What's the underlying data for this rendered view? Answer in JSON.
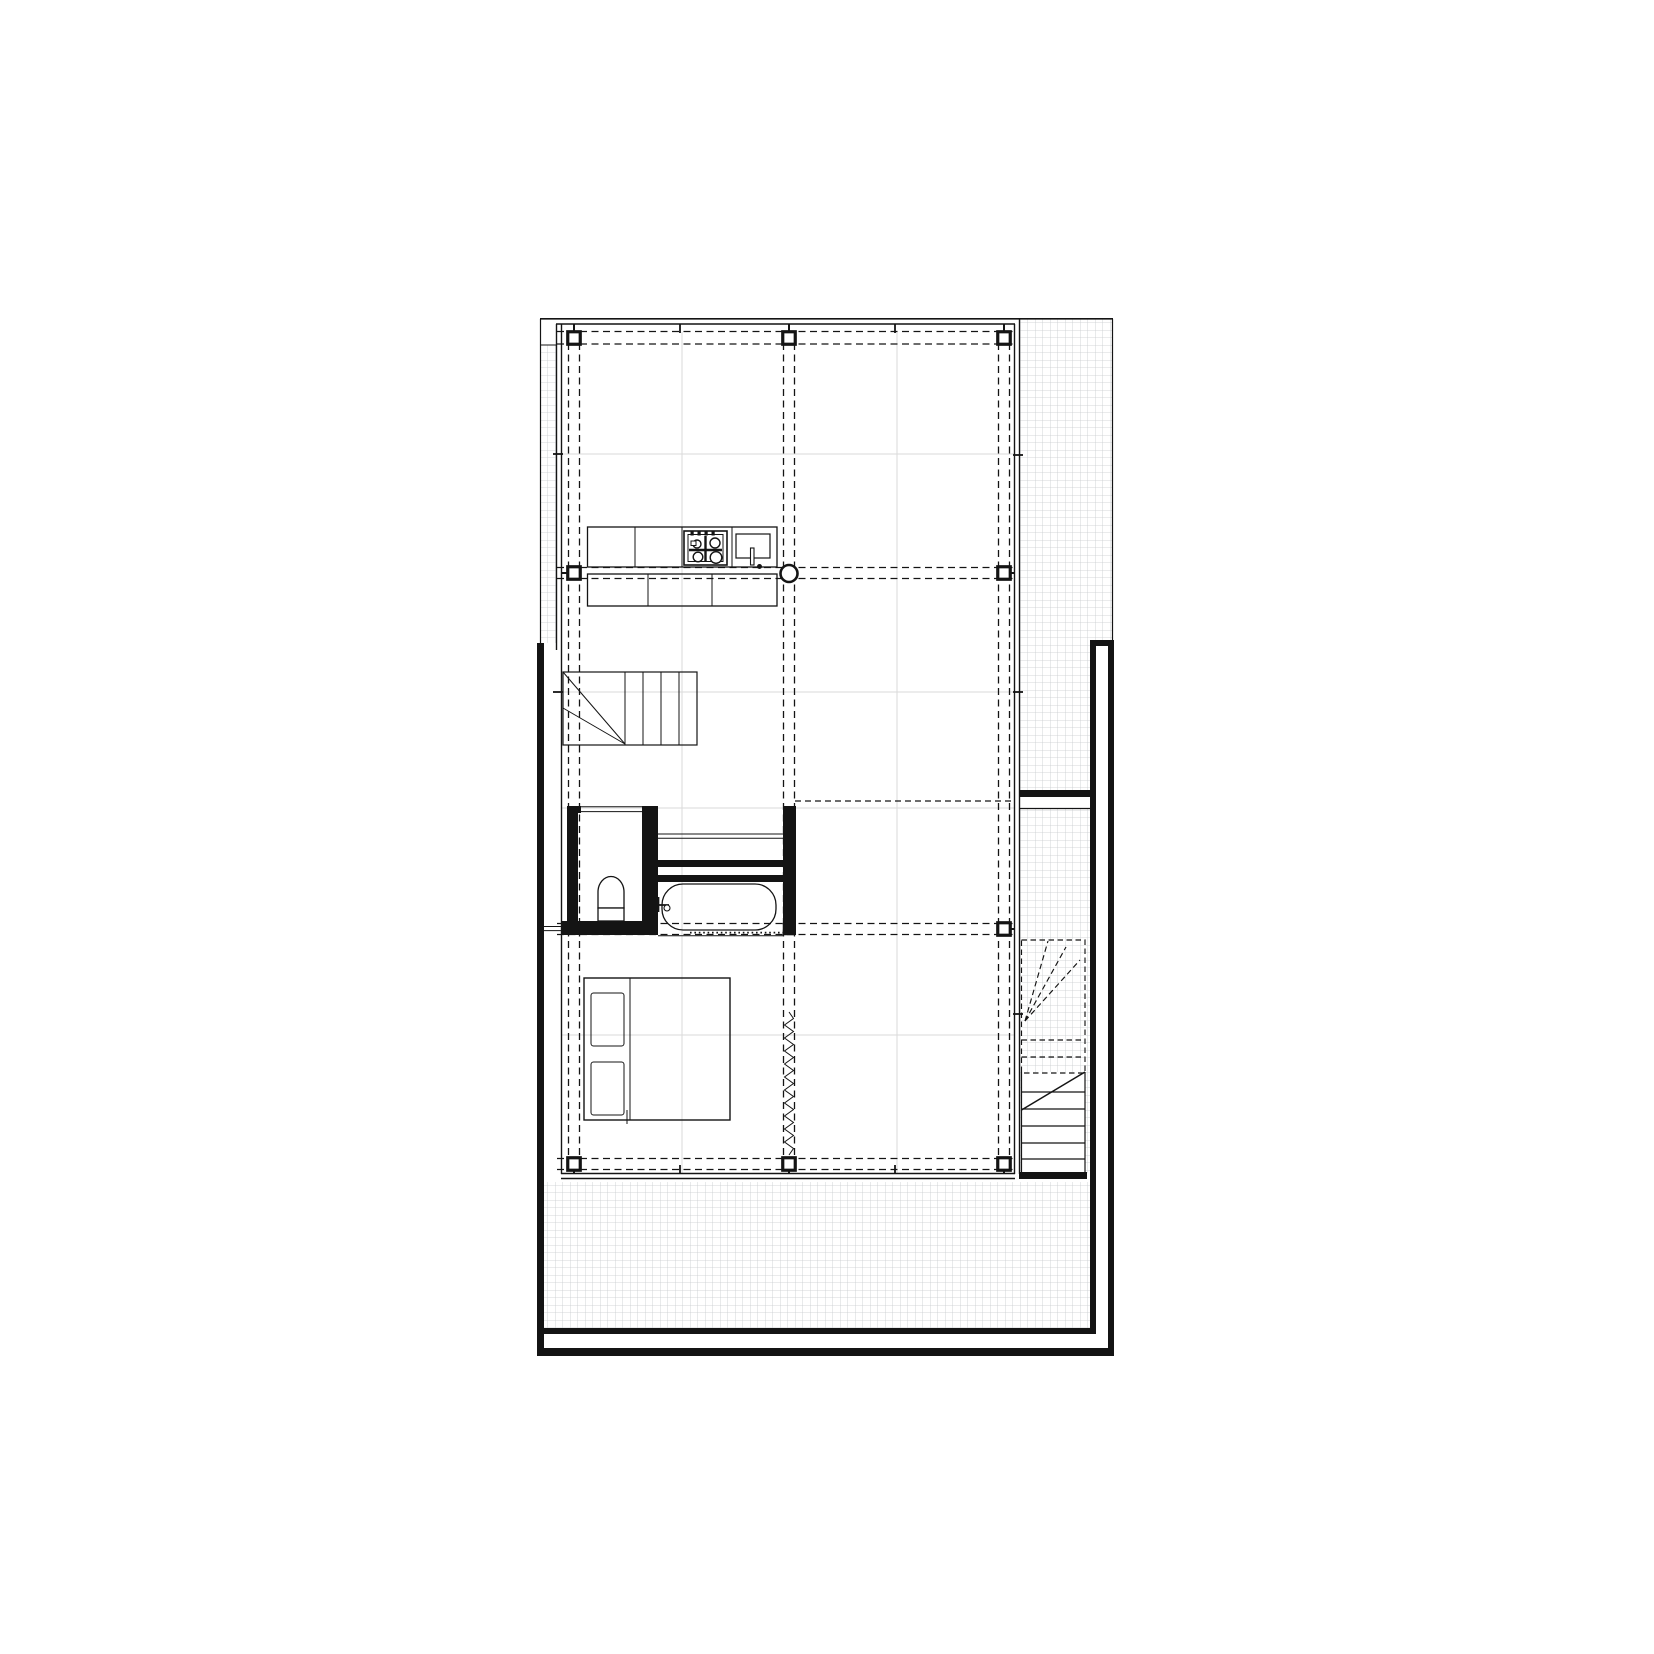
{
  "canvas": {
    "width_px": 1654,
    "height_px": 1654,
    "background": "#ffffff"
  },
  "colors": {
    "ink": "#141414",
    "hatch_line": "#c7cacd",
    "module_line": "#dadada",
    "paper": "#ffffff"
  },
  "hatch": {
    "cell_px": 7.5,
    "pattern": "small-square-grid"
  },
  "structural_grid": {
    "style": "paired dashed axis lines with hollow square columns at intersections",
    "pair_gap_px": 11,
    "vertical_axis_lines_x": [
      568.5,
      579.5,
      783.5,
      794.5,
      998.5,
      1009.5
    ],
    "vertical_extent_y": [
      331.5,
      1170
    ],
    "horizontal_axis_lines_y": [
      331.5,
      344,
      567.5,
      578.5,
      923.5,
      934.5,
      1158.5,
      1169.5
    ],
    "horizontal_extent_x": [
      557,
      1014
    ]
  },
  "columns": {
    "square_size_px": 12.5,
    "items": [
      {
        "cx": 574,
        "cy": 338,
        "style": "open"
      },
      {
        "cx": 789,
        "cy": 338,
        "style": "open"
      },
      {
        "cx": 1004,
        "cy": 338,
        "style": "open"
      },
      {
        "cx": 574,
        "cy": 573,
        "style": "open"
      },
      {
        "cx": 1004,
        "cy": 573,
        "style": "open"
      },
      {
        "cx": 789,
        "cy": 929,
        "style": "filled"
      },
      {
        "cx": 1004,
        "cy": 929,
        "style": "open"
      },
      {
        "cx": 574,
        "cy": 1164,
        "style": "open"
      },
      {
        "cx": 789,
        "cy": 1164,
        "style": "open"
      },
      {
        "cx": 1004,
        "cy": 1164,
        "style": "open"
      }
    ],
    "round_column": {
      "cx": 789,
      "cy": 573.5,
      "r": 8.5
    }
  },
  "curtain": {
    "x": 789,
    "y1": 1012,
    "y2": 1155,
    "amplitude": 4.5,
    "step": 6.5
  },
  "areas": [
    {
      "name": "terrace-strip-left",
      "rect": [
        541,
        345,
        16,
        298
      ]
    },
    {
      "name": "terrace-top-right",
      "rect": [
        1020,
        319,
        93,
        324
      ]
    },
    {
      "name": "terrace-strip-right-upper",
      "rect": [
        1020,
        643,
        70,
        147
      ]
    },
    {
      "name": "terrace-strip-right-lower",
      "rect": [
        1020,
        809,
        70,
        364
      ]
    },
    {
      "name": "terrace-bottom",
      "rect": [
        544,
        1182,
        546,
        146
      ]
    }
  ],
  "symbols": [
    "kitchen-counter",
    "cooktop-4-burner",
    "kitchen-sink",
    "winder-stair-interior",
    "exterior-stair-with-break-line",
    "wc-toilet",
    "bathtub",
    "bath-faucet",
    "double-bed-with-pillows",
    "curtain-zigzag",
    "glazed-facade-double-line",
    "mullion-ticks",
    "structural-columns",
    "round-column"
  ]
}
